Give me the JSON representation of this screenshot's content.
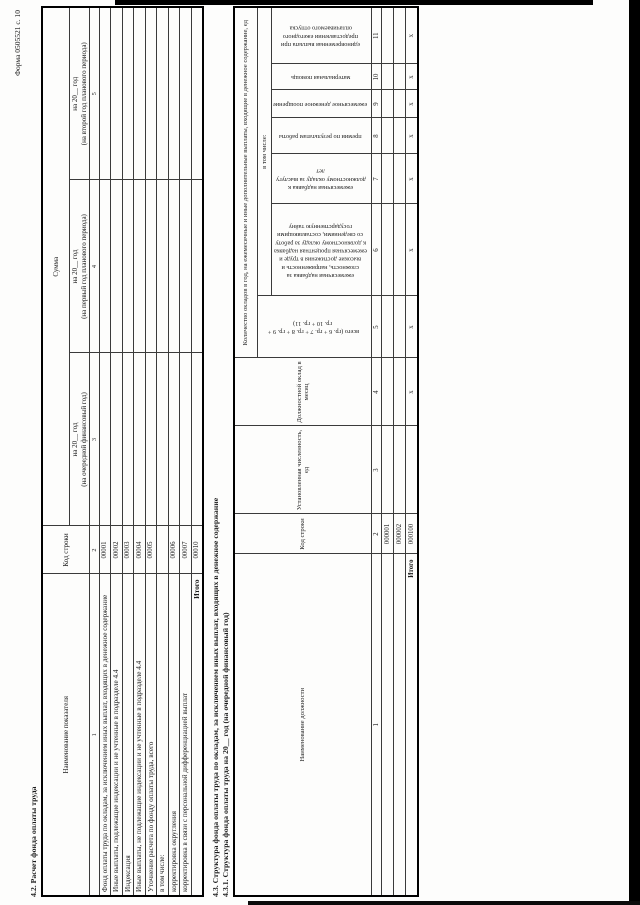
{
  "page": {
    "form_number": "Форма 0505521 с. 10"
  },
  "section42": {
    "title": "4.2. Расчет фонда оплаты труда",
    "header": {
      "name": "Наименование показателя",
      "code": "Код строки",
      "sum": "Сумма",
      "year1_line1": "на 20__ год",
      "year1_line2": "(на очередной финансовый год)",
      "year2_line1": "на 20__ год",
      "year2_line2": "(на первый год планового периода)",
      "year3_line1": "на 20__ год",
      "year3_line2": "(на второй год планового периода)"
    },
    "col_numbers": [
      "1",
      "2",
      "3",
      "4",
      "5"
    ],
    "rows": [
      {
        "label": "Фонд оплаты труда по окладам, за исключением иных выплат, входящих в денежное содержание",
        "code": "00001"
      },
      {
        "label": "Иные выплаты, подлежащие индексации и не учтенные в подразделе 4.4",
        "code": "00002"
      },
      {
        "label": "Индексация",
        "code": "00003"
      },
      {
        "label": "Иные выплаты, не подлежащие индексации и не учтенные в подразделе 4.4",
        "code": "00004"
      },
      {
        "label": "Уточнение расчета по фонду оплаты труда, всего",
        "code": "00005"
      },
      {
        "label": "в том числе:",
        "code": ""
      },
      {
        "label": "корректировка округления",
        "code": "00006"
      },
      {
        "label": "корректировка в связи с персональной дифференциацией выплат",
        "code": "00007"
      },
      {
        "label": "Итого",
        "code": "00010"
      }
    ]
  },
  "section43": {
    "title": "4.3. Структура фонда оплаты труда по окладам, за исключением иных выплат, входящих в денежное содержание",
    "subtitle": "4.3.1. Структура фонда оплаты труда на 20__ год (на очередной финансовый год)",
    "header": {
      "position": "Наименование должности",
      "code": "Код строки",
      "staff": "Установленная численность, ед",
      "salary": "Должностной оклад в месяц",
      "okladi_group": "Количество окладов в год, на ежемесячные и иные дополнительные выплаты, входящие в денежное содержание, ед",
      "including": "в том числе:",
      "col5": "всего (гр. 6 + гр. 7 + гр. 8 + гр. 9 + гр. 10 + гр. 11)",
      "col6": "ежемесячная надбавка за сложность, напряженность и высокие достижения в труде и ежемесячная процентная надбавка к должностному окладу за работу со сведениями, составляющими государственную тайну",
      "col7": "ежемесячная надбавка к должностному окладу за выслугу лет",
      "col8": "премии по результатам работы",
      "col9": "ежемесячное денежное поощрение",
      "col10": "материальная помощь",
      "col11": "единовременная выплата при предоставлении ежегодного оплачиваемого отпуска"
    },
    "col_numbers": [
      "1",
      "2",
      "3",
      "4",
      "5",
      "6",
      "7",
      "8",
      "9",
      "10",
      "11"
    ],
    "rows": [
      {
        "code": "000001"
      },
      {
        "code": "000002"
      }
    ],
    "total": {
      "label": "Итого",
      "code": "000100",
      "x_mark": "х"
    }
  }
}
